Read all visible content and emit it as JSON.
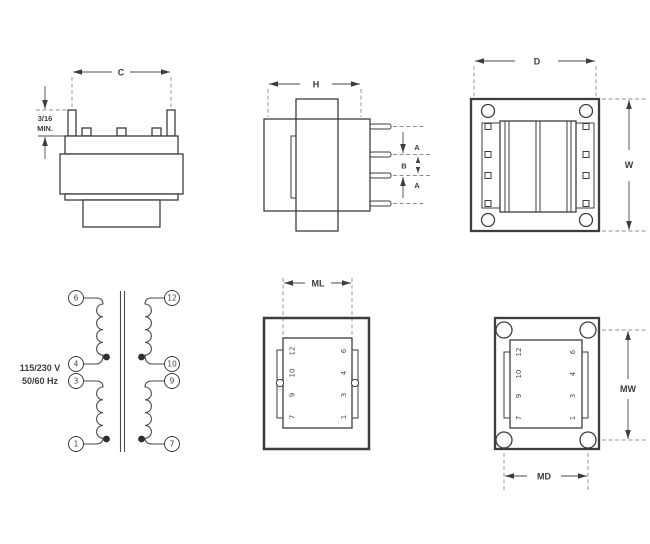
{
  "views": {
    "front": {
      "dim_c": "C",
      "pin_min_line1": "3/16",
      "pin_min_line2": "MIN."
    },
    "side": {
      "dim_h": "H",
      "dim_a_top": "A",
      "dim_b": "B",
      "dim_a_bottom": "A"
    },
    "top": {
      "dim_d": "D",
      "dim_w": "W"
    },
    "schematic": {
      "voltage": "115/230 V",
      "frequency": "50/60 Hz",
      "left_terminals": [
        "6",
        "4",
        "3",
        "1"
      ],
      "right_terminals": [
        "12",
        "10",
        "9",
        "7"
      ]
    },
    "bottom_footprint": {
      "dim_ml": "ML",
      "left_pins": [
        "12",
        "10",
        "9",
        "7"
      ],
      "right_pins": [
        "6",
        "4",
        "3",
        "1"
      ]
    },
    "mounting_footprint": {
      "dim_mw": "MW",
      "dim_md": "MD",
      "left_pins": [
        "12",
        "10",
        "9",
        "7"
      ],
      "right_pins": [
        "6",
        "4",
        "3",
        "1"
      ]
    }
  }
}
